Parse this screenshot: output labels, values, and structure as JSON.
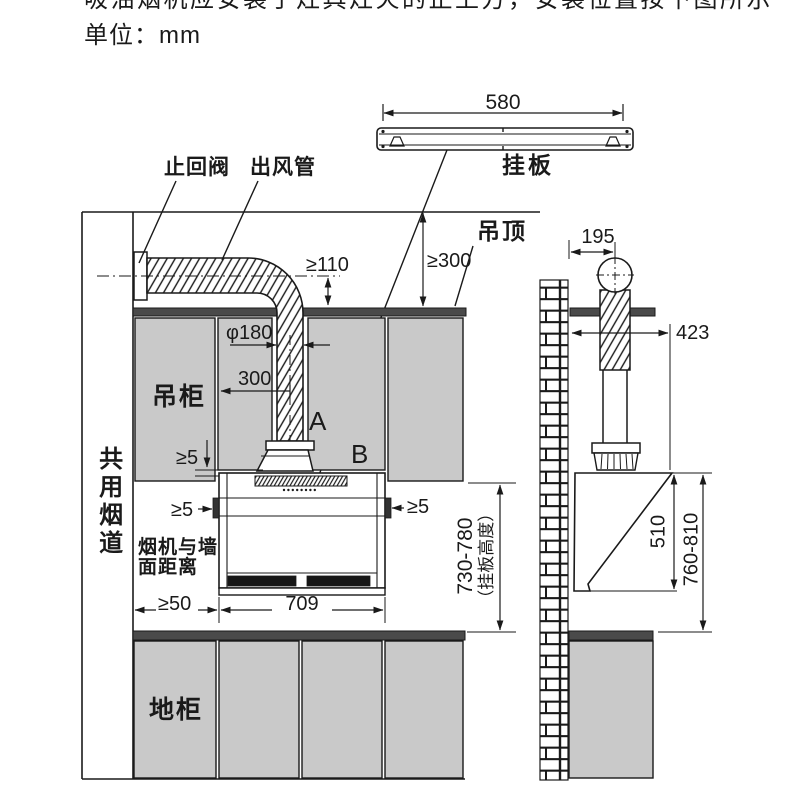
{
  "header": {
    "title_clipped": "吸油烟机应安装于灶具灶火的正上方，安装位置按下图所示",
    "unit": "单位：mm"
  },
  "plate_detail": {
    "width": "580",
    "label": "挂板"
  },
  "front_view": {
    "check_valve": "止回阀",
    "outlet_pipe": "出风管",
    "ceiling": "吊顶",
    "wall_cabinet": "吊柜",
    "shared_flue": "共用烟道",
    "floor_cabinet": "地柜",
    "hood_wall_distance_line1": "烟机与墙",
    "hood_wall_distance_line2": "面距离",
    "point_a": "A",
    "point_b": "B",
    "dims": {
      "duct_to_ceiling": "≥110",
      "ceiling_height": "≥300",
      "duct_diameter": "φ180",
      "duct_offset": "300",
      "top_gap": "≥5",
      "left_gap": "≥5",
      "right_gap": "≥5",
      "flue_clearance": "≥50",
      "hood_width": "709",
      "plate_height": "730-780",
      "plate_height_note": "（挂板高度）"
    }
  },
  "side_view": {
    "dims": {
      "wall_to_duct": "195",
      "wall_to_front": "423",
      "hood_height": "510",
      "hood_to_counter": "760-810"
    }
  },
  "colors": {
    "cabinet": "#c9c9c9",
    "band": "#4a4a4a",
    "line": "#1a1a1a"
  }
}
